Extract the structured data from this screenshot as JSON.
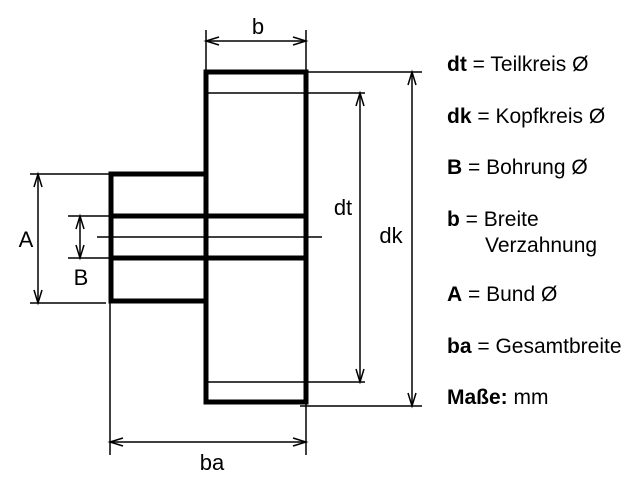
{
  "figure": {
    "type": "technical-drawing",
    "subject": "Zahnrad (gear) dimension diagram",
    "background_color": "#ffffff",
    "line_color": "#000000"
  },
  "diagram": {
    "labels": {
      "b": "b",
      "dt": "dt",
      "dk": "dk",
      "A": "A",
      "B": "B",
      "ba": "ba"
    }
  },
  "legend": {
    "items": [
      {
        "key": "dt",
        "text": "= Teilkreis Ø"
      },
      {
        "key": "dk",
        "text": "= Kopfkreis Ø"
      },
      {
        "key": "B",
        "text": "= Bohrung Ø"
      },
      {
        "key": "b",
        "text": "= Breite",
        "text2": "Verzahnung"
      },
      {
        "key": "A",
        "text": "= Bund Ø"
      },
      {
        "key": "ba",
        "text": "= Gesamtbreite"
      },
      {
        "key": "Maße:",
        "text": "mm"
      }
    ]
  }
}
